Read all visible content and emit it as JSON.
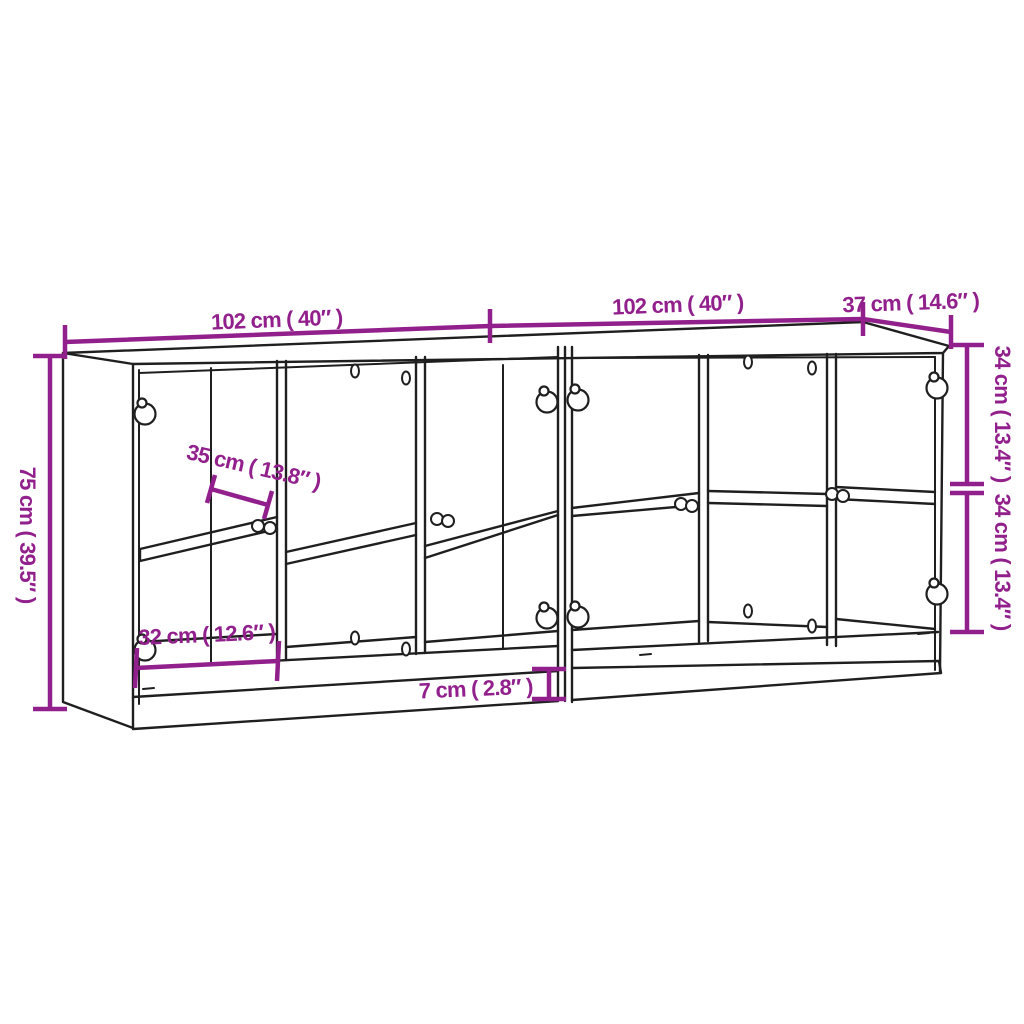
{
  "style": {
    "background": "#ffffff",
    "outline_color": "#1f1f1f",
    "dimension_color": "#92208C"
  },
  "diagram": {
    "type": "furniture-dimension-drawing",
    "subject": "Two-section bookcase sideboard with glass doors, knobs and middle shelves, drawn in perspective outline",
    "units": "centimeters with inches in parentheses",
    "labels": {
      "width_left": "102 cm ( 40″ )",
      "width_right": "102 cm ( 40″ )",
      "depth": "37 cm ( 14.6″ )",
      "height": "75 cm ( 39.5″ )",
      "upper_section_height": "34 cm ( 13.4″ )",
      "lower_section_height": "34 cm ( 13.4″ )",
      "shelf_depth": "35 cm ( 13.8″ )",
      "compartment_width": "32 cm ( 12.6″ )",
      "plinth_height": "7 cm ( 2.8″ )"
    },
    "values": {
      "width_left_cm": 102,
      "width_left_in": 40,
      "width_right_cm": 102,
      "width_right_in": 40,
      "depth_cm": 37,
      "depth_in": 14.6,
      "height_cm": 75,
      "height_in": 39.5,
      "upper_section_cm": 34,
      "upper_section_in": 13.4,
      "lower_section_cm": 34,
      "lower_section_in": 13.4,
      "shelf_depth_cm": 35,
      "shelf_depth_in": 13.8,
      "compartment_width_cm": 32,
      "compartment_width_in": 12.6,
      "plinth_cm": 7,
      "plinth_in": 2.8
    }
  }
}
